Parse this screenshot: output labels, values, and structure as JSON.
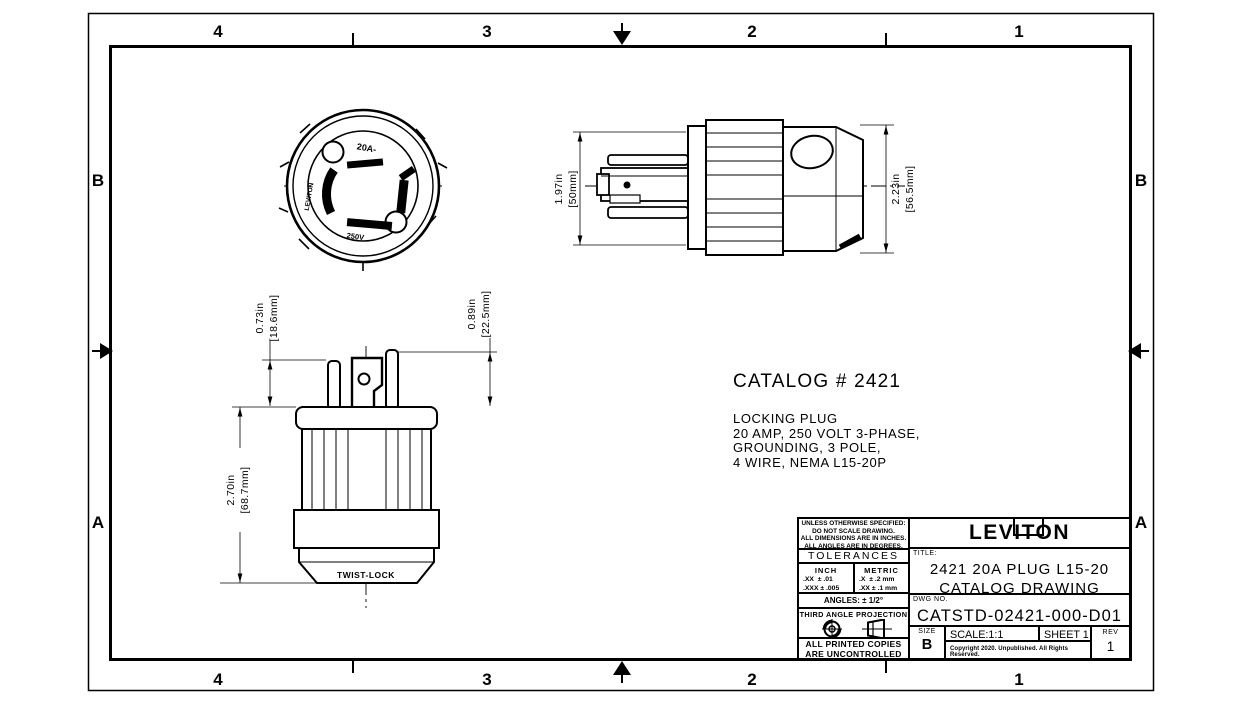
{
  "page": {
    "background": "#ffffff",
    "line_color": "#000000"
  },
  "zones": {
    "top": [
      "4",
      "3",
      "2",
      "1"
    ],
    "bottom": [
      "4",
      "3",
      "2",
      "1"
    ],
    "left": [
      "B",
      "A"
    ],
    "right": [
      "B",
      "A"
    ]
  },
  "front_view": {
    "marking_top": "20A-",
    "marking_side": "LEVITON",
    "marking_bottom": "250V"
  },
  "bottom_view": {
    "molded_text": "TWIST-LOCK"
  },
  "dimensions": {
    "plug_length": {
      "in_value": "1.97in",
      "mm_value": "[50mm]"
    },
    "plug_height": {
      "in_value": "2.23in",
      "mm_value": "[56.5mm]"
    },
    "blade_left": {
      "in_value": "0.73in",
      "mm_value": "[18.6mm]"
    },
    "blade_right": {
      "in_value": "0.89in",
      "mm_value": "[22.5mm]"
    },
    "body_length": {
      "in_value": "2.70in",
      "mm_value": "[68.7mm]"
    }
  },
  "catalog": {
    "heading": "CATALOG # 2421",
    "lines": [
      "LOCKING PLUG",
      "20 AMP, 250 VOLT 3-PHASE,",
      "GROUNDING, 3 POLE,",
      "4 WIRE, NEMA L15-20P"
    ]
  },
  "title_block": {
    "notes": [
      "UNLESS OTHERWISE SPECIFIED:",
      "DO NOT SCALE DRAWING.",
      "ALL DIMENSIONS ARE IN INCHES.",
      "ALL ANGLES ARE IN DEGREES."
    ],
    "tolerances_heading": "TOLERANCES",
    "inch_header": "INCH",
    "metric_header": "METRIC",
    "inch_rows": [
      ".XX  ± .01",
      ".XXX ± .005"
    ],
    "metric_rows": [
      ".X  ± .2 mm",
      ".XX ± .1 mm"
    ],
    "angles": "ANGLES: ± 1/2°",
    "projection_label": "THIRD ANGLE PROJECTION",
    "uncontrolled_lines": [
      "ALL PRINTED COPIES",
      "ARE UNCONTROLLED"
    ],
    "logo": "LEVITON",
    "title_label": "TITLE:",
    "title_lines": [
      "2421 20A PLUG L15-20",
      "CATALOG DRAWING"
    ],
    "dwg_label": "DWG NO.",
    "dwg_number": "CATSTD-02421-000-D01",
    "size_label": "SIZE",
    "size_value": "B",
    "scale_text": "SCALE:1:1",
    "sheet_text": "SHEET 1 OF 1",
    "rev_label": "REV",
    "rev_value": "1",
    "copyright": "Copyright 2020. Unpublished. All Rights Reserved."
  }
}
